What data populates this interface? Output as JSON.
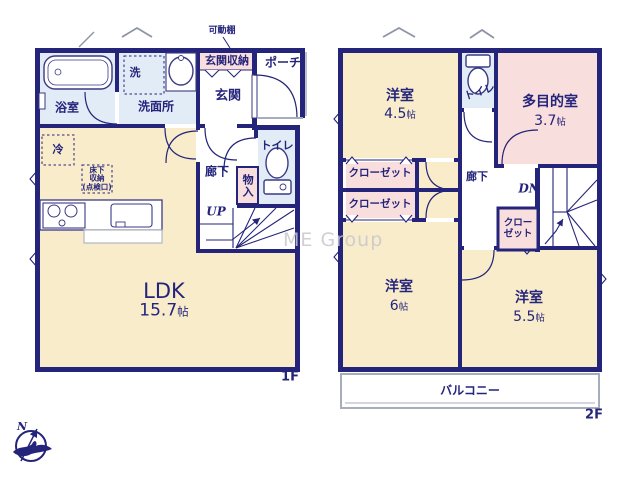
{
  "colors": {
    "wall_navy": "#24247b",
    "room_cream": "#f9eccb",
    "room_pink": "#f9dede",
    "room_blue": "#e2ecf7",
    "window_gray": "#b9c0cc",
    "watermark_gray": "#c7c7cd"
  },
  "watermark": "ME Group",
  "compass": {
    "north_label": "N"
  },
  "floor1": {
    "label": "1F",
    "rooms": {
      "bath": "浴室",
      "laundry": "洗",
      "washroom": "洗面所",
      "movable_shelf": "可動棚",
      "entrance_storage": "玄関収納",
      "porch": "ポーチ",
      "entrance": "玄関",
      "fridge": "冷",
      "underfloor_storage_lines": [
        "床下",
        "収納",
        "(点検口)"
      ],
      "hallway": "廊下",
      "toilet": "トイレ",
      "storage": "物入",
      "stairs_up": "UP",
      "ldk_name": "LDK",
      "ldk_size_value": "15.7",
      "size_unit": "帖"
    }
  },
  "floor2": {
    "label": "2F",
    "rooms": {
      "bedroom1_name": "洋室",
      "bedroom1_size": "4.5",
      "toilet": "トイレ",
      "multipurpose_name": "多目的室",
      "multipurpose_size": "3.7",
      "closet1": "クローゼット",
      "closet2": "クローゼット",
      "closet3_lines": [
        "クロー",
        "ゼット"
      ],
      "hallway": "廊下",
      "stairs_down": "DN",
      "bedroom2_name": "洋室",
      "bedroom2_size": "6",
      "bedroom3_name": "洋室",
      "bedroom3_size": "5.5",
      "balcony": "バルコニー",
      "size_unit": "帖"
    }
  }
}
